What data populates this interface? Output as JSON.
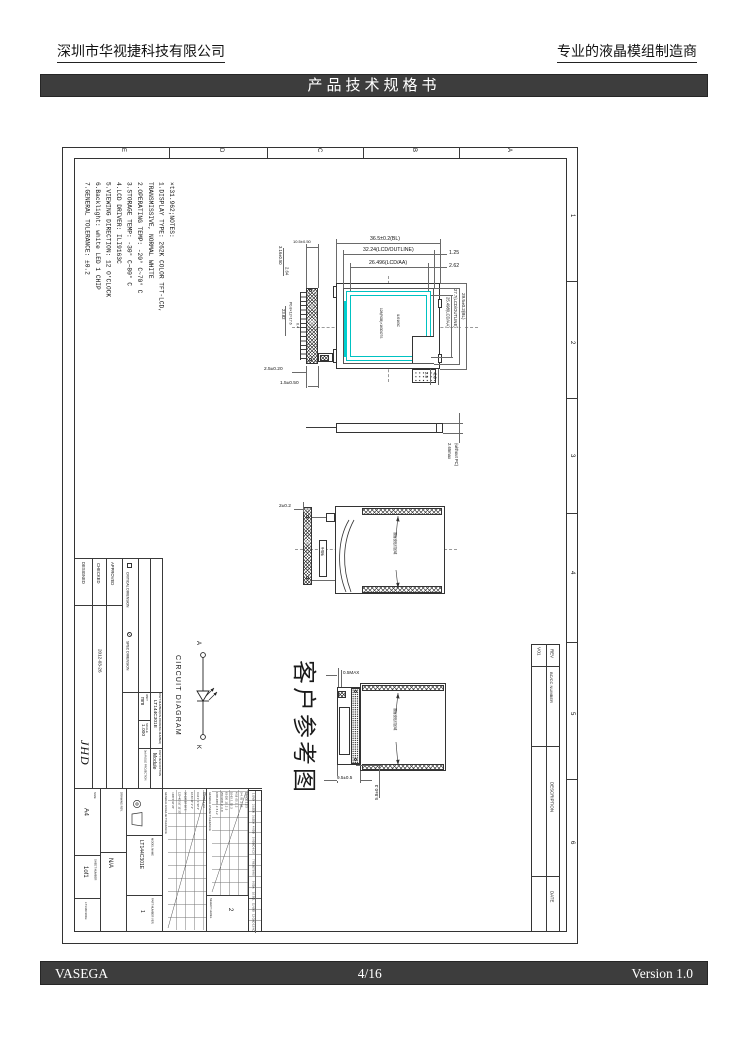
{
  "header": {
    "company_left": "深圳市华视捷科技有限公司",
    "company_right": "专业的液晶模组制造商",
    "banner_title": "产品技术规格书"
  },
  "footer": {
    "brand": "VASEGA",
    "page": "4/16",
    "version": "Version 1.0"
  },
  "frame": {
    "zone_letters": [
      "E",
      "D",
      "C",
      "B",
      "A"
    ],
    "zone_numbers": [
      "1",
      "2",
      "3",
      "4",
      "5",
      "6"
    ]
  },
  "notes": {
    "text": "×t31.962;NOTES:\n1.DISPLAY TYPE:  262K COLOR TFT-LCD,\n   TRANSMISSIVE, NORMAL WHITE\n2.OPERATING TEMP:  -20° C~70° C\n3.STORAGE TEMP:  -30° C~80° C\n4.LCD DRIVER:  ILI9163C\n5.VIEWING DIRECTION:  12 O'CLOCK\n6.Backlight: white LED 1 CHIP\n7.GENERAL TOLERANCE:  ±0.2"
  },
  "front": {
    "dim_bl": "36.5±0.2(BL)",
    "dim_outline": "32.24(LCD/OUTLINE)",
    "dim_aa": "26.496(LCD/AA)",
    "dim_125": "1.25",
    "dim_262": "2.62",
    "dim_fpc": "10.5±0.50",
    "dim_316": "3.16±0.50",
    "dim_264": "2.64",
    "dim_2382": "23.82",
    "dim_pitch": "P0.8×12=17.6",
    "dim_04": "0.4",
    "dim_25": "2.5±0.20",
    "dim_15": "1.5±0.50",
    "dim_r_aa": "25.498(LCD/AA)",
    "dim_r_outline": "27.7(LCD/OUTLINE)",
    "dim_r_bl": "29.5±0.2(BL)",
    "dim_29": "2.9",
    "dim_09": "0.9",
    "note_dots": "128(RGB)×160DOTS",
    "note_ic": "ILI9163C"
  },
  "side": {
    "dim": "2.65max\n(without PC)"
  },
  "back": {
    "dim": "2±0.2",
    "tape_note": "双面胶贴付区域",
    "stiffener": "补强板"
  },
  "ref": {
    "label": "客户参考图",
    "dim_05": "0.5MAX",
    "dim_95": "9.5±0.5",
    "dim_58": "5.8±0.3",
    "tape_note": "双面胶贴付区域"
  },
  "circuit": {
    "title": "CIRCUIT DIAGRAM",
    "a": "A",
    "k": "K"
  },
  "tb": {
    "approved": "APPROVED",
    "checked": "CHECKED",
    "designed": "DESIGNED",
    "date": "2012-03-26",
    "signature": "JHD",
    "legend_critical": "CRITICAL DIMENSION",
    "legend_spec": "SPEC DIMENSION",
    "unit_label": "UNIT",
    "unit_value": "mm",
    "scale_label": "SCALE",
    "scale_value": "1.000",
    "pn_label": "PART NUMBER(CN-DRAWING NUMBER)",
    "pn_value": "LT144C301E",
    "pd_label": "PART DESCRIPTION",
    "pd_value": "Module",
    "angle_label": "3rd ANGLE PROJECTION",
    "model_label": "MODEL NAME",
    "model_value": "LT144C301E",
    "ver_label": "PART NUMBER VER.",
    "ver_value": "1",
    "rev_label": "DRAWING REV.",
    "rev_value": "N/A",
    "size_label": "SIZE",
    "size_value": "A4",
    "sheet_label": "SHEET NUMBER",
    "sheet_value": "1of1",
    "doc_code": "LT144C301E"
  },
  "tol": {
    "angular_title": "GENERAL ANGULAR TOLERANCE",
    "angular_grid": "RANGE 1 2 3\n0-10 1° 1°30′ 3°\n10-50 30′ 1° 2°\n50-120 20′ 30′ 1°\n120-400 10′ 15′ 30′\n>400 5′ 10′ 20′",
    "linear_title": "GENERAL LINEAR TOLERANCE",
    "linear_grid": "RANGE 1 2 3\n0-4 .05 .1 .15\n4-16 .05 .1 .2\n16-63 .1 .15 .3\n63-250 .15 .2 .5\n250-1000 .2 .3 .8\n1000-4000 .3 .5 1.2",
    "select_label": "SELECT LEVEL",
    "select_value": "2"
  },
  "pins": {
    "rows": [
      "1 GND",
      "2 LEDK",
      "3 LEDA",
      "4 VDD",
      "5 VDDIO",
      "6 CS",
      "7 RESET",
      "8 RS",
      "9 SDA",
      "10 SCL",
      "11 VDD",
      "12 GND",
      "13 NC"
    ]
  },
  "rev": {
    "rev_label": "REV",
    "rev_value": "V01",
    "bccc_label": "BC/CC NUMBER",
    "desc_label": "DESCRIPTION",
    "date_label": "DATE"
  }
}
